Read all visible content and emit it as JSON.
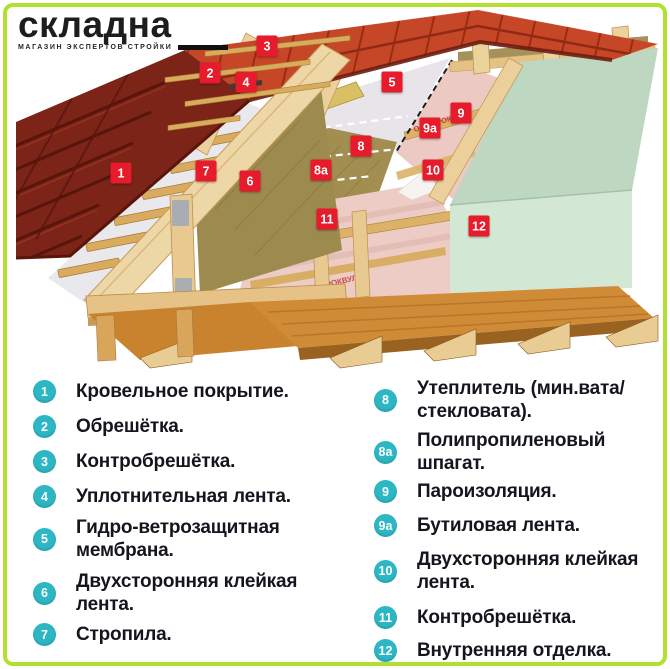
{
  "brand": {
    "name": "складна",
    "tagline": "МАГАЗИН ЭКСПЕРТОВ СТРОЙКИ"
  },
  "illustration": {
    "membrane_print": "ООО «РОКВУЛ»"
  },
  "colors": {
    "frame_border": "#b2e030",
    "marker_red": "#e61b2b",
    "badge_teal": "#2db7c5",
    "text_dark": "#15151e",
    "tiles_bright": "#c64628",
    "tiles_dark": "#7c2418",
    "wood_light": "#eed7a6",
    "insulation_olive": "#a28e51",
    "vapor_pink": "#edccc5",
    "interior_green": "#d3e8d4",
    "floor_wood": "#d08b37"
  },
  "markers": [
    {
      "id": "1",
      "label": "1"
    },
    {
      "id": "2",
      "label": "2"
    },
    {
      "id": "3",
      "label": "3"
    },
    {
      "id": "4",
      "label": "4"
    },
    {
      "id": "5",
      "label": "5"
    },
    {
      "id": "6",
      "label": "6"
    },
    {
      "id": "7",
      "label": "7"
    },
    {
      "id": "8",
      "label": "8"
    },
    {
      "id": "8a",
      "label": "8а"
    },
    {
      "id": "9",
      "label": "9"
    },
    {
      "id": "9a",
      "label": "9а"
    },
    {
      "id": "10",
      "label": "10"
    },
    {
      "id": "11",
      "label": "11"
    },
    {
      "id": "12",
      "label": "12"
    }
  ],
  "legend": {
    "left": [
      {
        "num": "1",
        "label": "Кровельное покрытие."
      },
      {
        "num": "2",
        "label": "Обрешётка."
      },
      {
        "num": "3",
        "label": "Контробрешётка."
      },
      {
        "num": "4",
        "label": "Уплотнительная лента."
      },
      {
        "num": "5",
        "label": "Гидро-ветрозащитная\nмембрана."
      },
      {
        "num": "6",
        "label": "Двухсторонняя клейкая\nлента."
      },
      {
        "num": "7",
        "label": "Стропила."
      }
    ],
    "right": [
      {
        "num": "8",
        "label": "Утеплитель (мин.вата/\nстекловата)."
      },
      {
        "num": "8а",
        "label": "Полипропиленовый\nшпагат."
      },
      {
        "num": "9",
        "label": "Пароизоляция."
      },
      {
        "num": "9а",
        "label": "Бутиловая лента."
      },
      {
        "num": "10",
        "label": "Двухсторонняя клейкая\nлента."
      },
      {
        "num": "11",
        "label": "Контробрешётка."
      },
      {
        "num": "12",
        "label": "Внутренняя отделка."
      }
    ]
  }
}
